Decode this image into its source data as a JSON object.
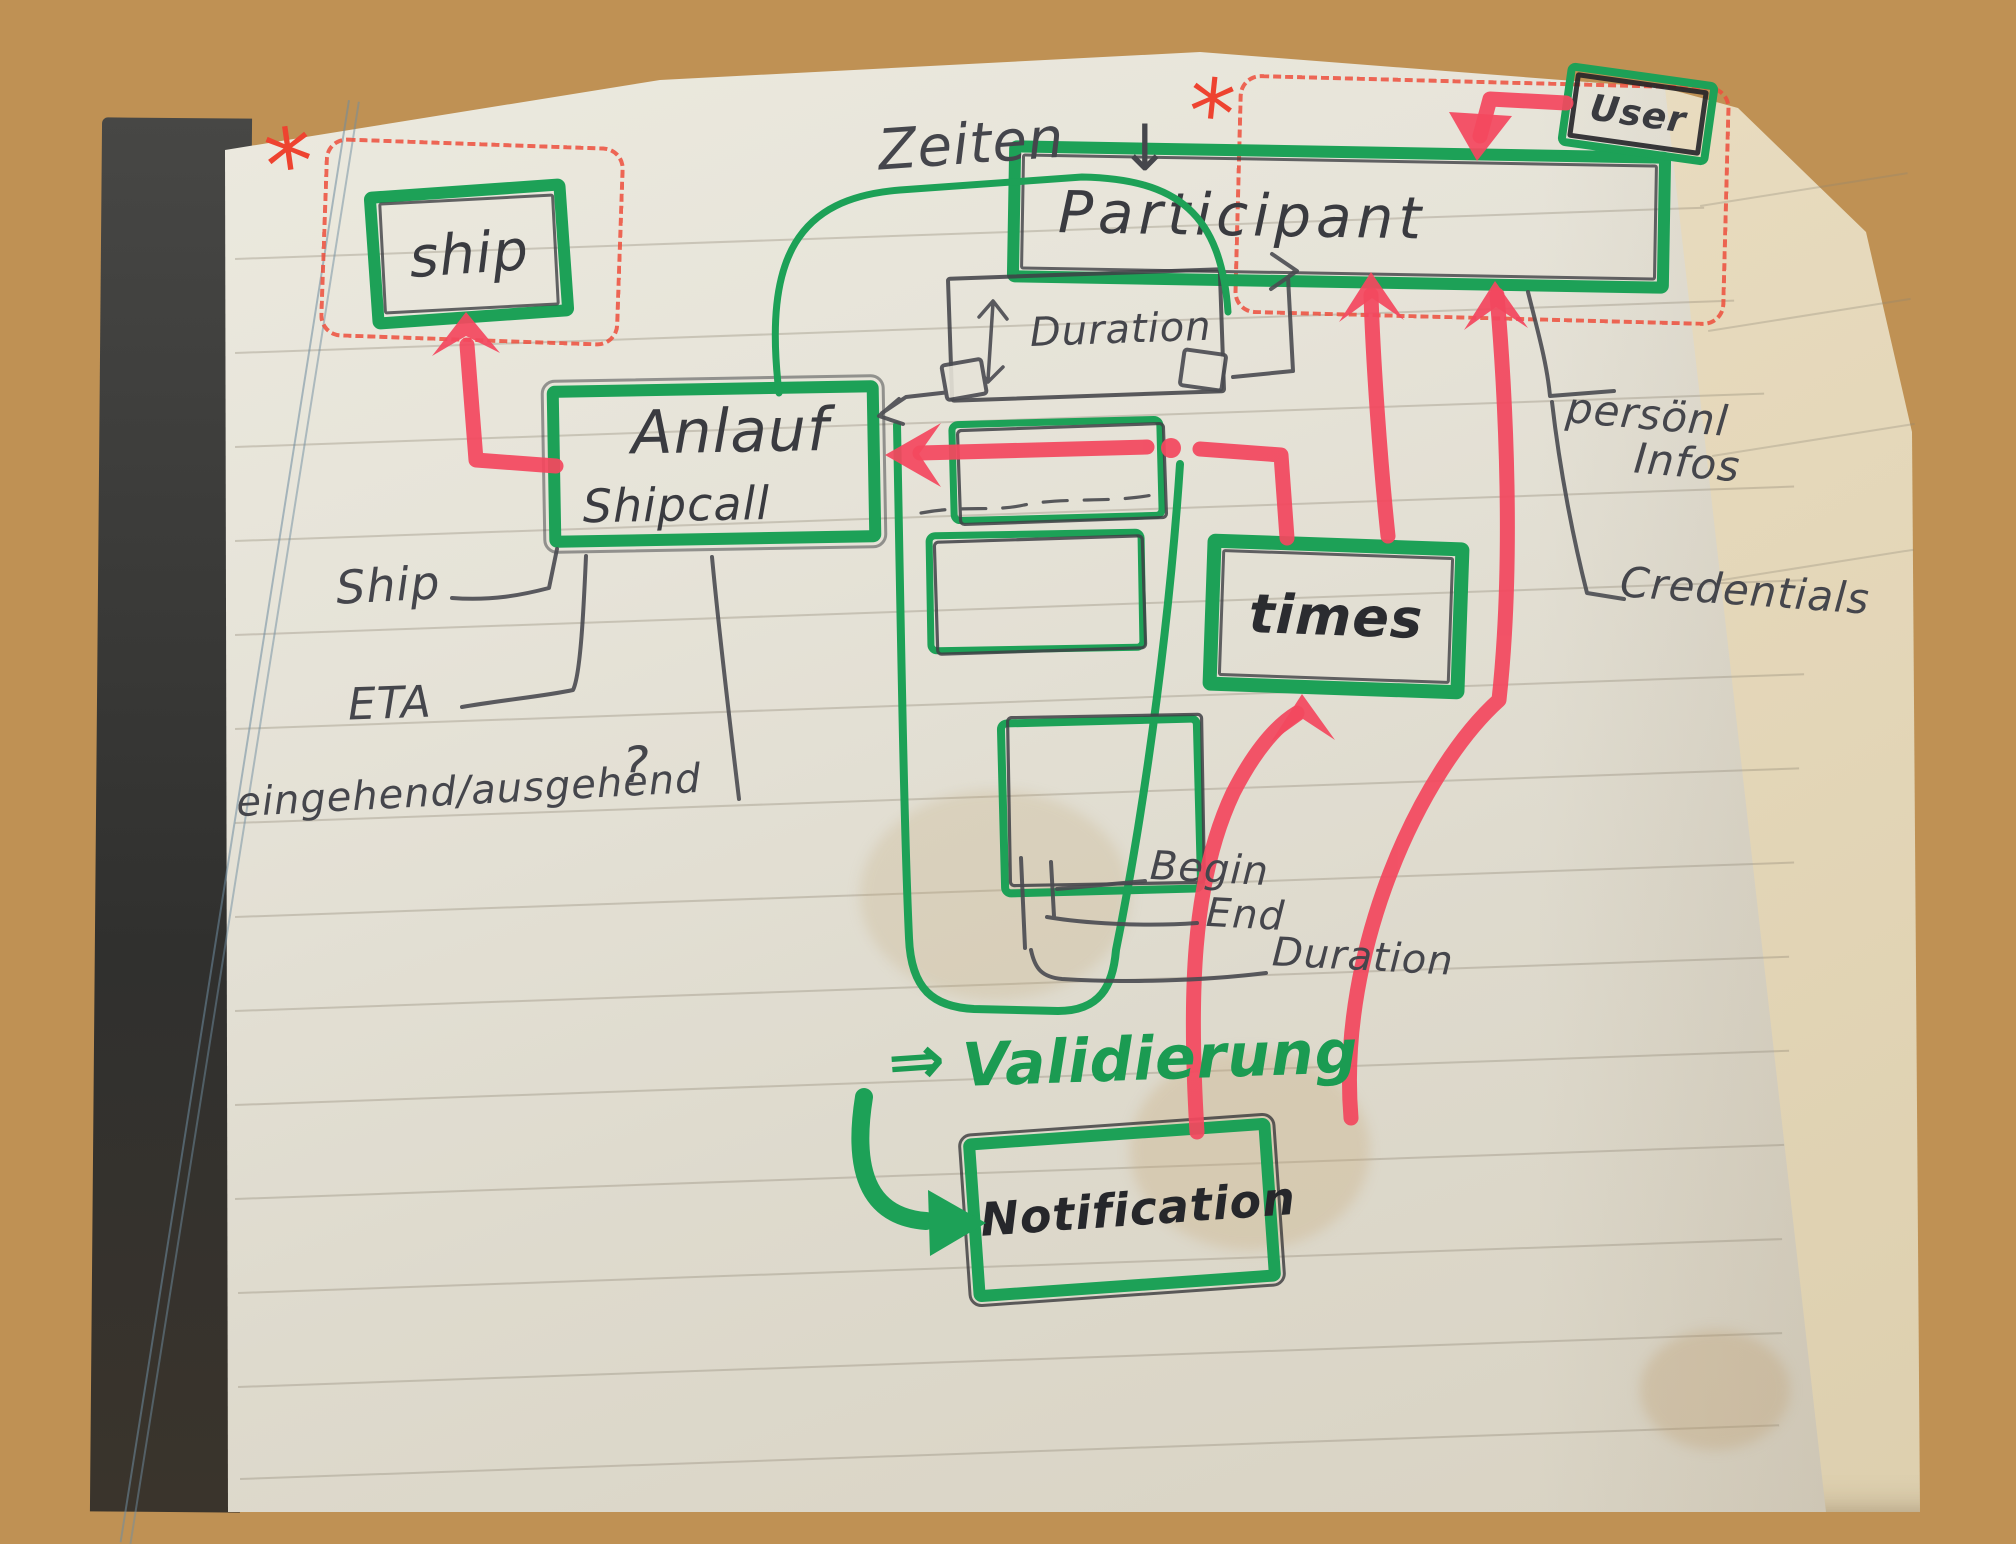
{
  "entities": {
    "ship": {
      "label": "ship"
    },
    "anlauf": {
      "label": "Anlauf",
      "sublabel": "Shipcall"
    },
    "participant": {
      "label": "Participant"
    },
    "user": {
      "label": "User"
    },
    "duration": {
      "label": "Duration"
    },
    "times": {
      "label": "times"
    },
    "notification": {
      "label": "Notification"
    }
  },
  "annotations": {
    "zeiten": "Zeiten",
    "zeiten_arrow": "↓",
    "validierung_arrow": "⇒",
    "validierung": "Validierung",
    "question_mark": "?",
    "asterisk": "*"
  },
  "field_labels": {
    "ship": "Ship",
    "eta": "ETA",
    "direction": "eingehend/ausgehend",
    "begin": "Begin",
    "end": "End",
    "duration": "Duration",
    "personal_line1": "persönl",
    "personal_line2": "Infos",
    "credentials": "Credentials"
  },
  "colors": {
    "marker_green": "#1da157",
    "marker_red": "#f3485f",
    "dashed_red": "#ee4f3d",
    "pencil": "#45464c"
  }
}
